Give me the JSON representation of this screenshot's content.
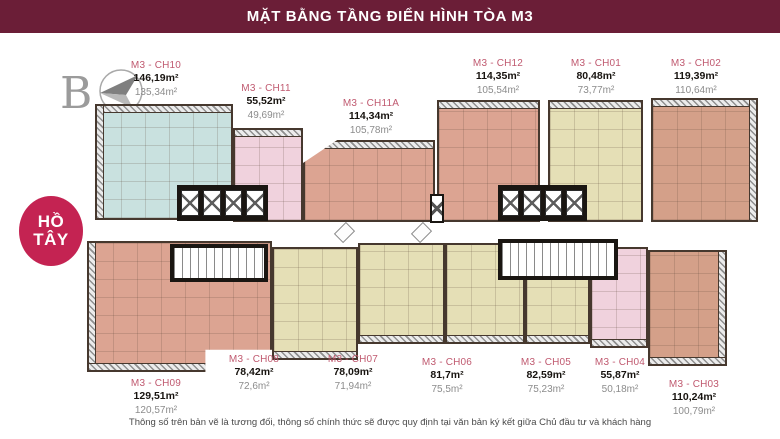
{
  "header": {
    "title": "MẶT BẰNG TẦNG ĐIỂN HÌNH TÒA M3"
  },
  "compass": {
    "label": "B"
  },
  "lake_badge": {
    "line1": "HỒ",
    "line2": "TÂY"
  },
  "disclaimer": "Thông số trên bản vẽ là tương đối, thông số chính thức sẽ được quy định tại văn bản ký kết giữa Chủ đầu tư và khách hàng",
  "colors": {
    "header_bg": "#6B1E37",
    "badge_bg": "#C42352",
    "unit_code_text": "#C05A70",
    "teal": "#C9E1DF",
    "pink": "#F0D2DD",
    "salmon": "#DCA492",
    "salmon_dark": "#D4A089",
    "beige": "#E5DFB6"
  },
  "units": [
    {
      "id": "ch10",
      "code": "M3 - CH10",
      "area_gross": "146,19m²",
      "area_net": "135,34m²",
      "color": "#C9E1DF"
    },
    {
      "id": "ch11",
      "code": "M3 - CH11",
      "area_gross": "55,52m²",
      "area_net": "49,69m²",
      "color": "#F0D2DD"
    },
    {
      "id": "ch11a",
      "code": "M3 - CH11A",
      "area_gross": "114,34m²",
      "area_net": "105,78m²",
      "color": "#DCA492"
    },
    {
      "id": "ch12",
      "code": "M3 - CH12",
      "area_gross": "114,35m²",
      "area_net": "105,54m²",
      "color": "#DCA492"
    },
    {
      "id": "ch01",
      "code": "M3 - CH01",
      "area_gross": "80,48m²",
      "area_net": "73,77m²",
      "color": "#E5DFB6"
    },
    {
      "id": "ch02",
      "code": "M3 - CH02",
      "area_gross": "119,39m²",
      "area_net": "110,64m²",
      "color": "#D4A089"
    },
    {
      "id": "ch09",
      "code": "M3 - CH09",
      "area_gross": "129,51m²",
      "area_net": "120,57m²",
      "color": "#DCA492"
    },
    {
      "id": "ch08",
      "code": "M3 - CH08",
      "area_gross": "78,42m²",
      "area_net": "72,6m²",
      "color": "#E5DFB6"
    },
    {
      "id": "ch07",
      "code": "M3 - CH07",
      "area_gross": "78,09m²",
      "area_net": "71,94m²",
      "color": "#E5DFB6"
    },
    {
      "id": "ch06",
      "code": "M3 - CH06",
      "area_gross": "81,7m²",
      "area_net": "75,5m²",
      "color": "#E5DFB6"
    },
    {
      "id": "ch05",
      "code": "M3 - CH05",
      "area_gross": "82,59m²",
      "area_net": "75,23m²",
      "color": "#E5DFB6"
    },
    {
      "id": "ch04",
      "code": "M3 - CH04",
      "area_gross": "55,87m²",
      "area_net": "50,18m²",
      "color": "#F0D2DD"
    },
    {
      "id": "ch03",
      "code": "M3 - CH03",
      "area_gross": "110,24m²",
      "area_net": "100,79m²",
      "color": "#D4A089"
    }
  ]
}
